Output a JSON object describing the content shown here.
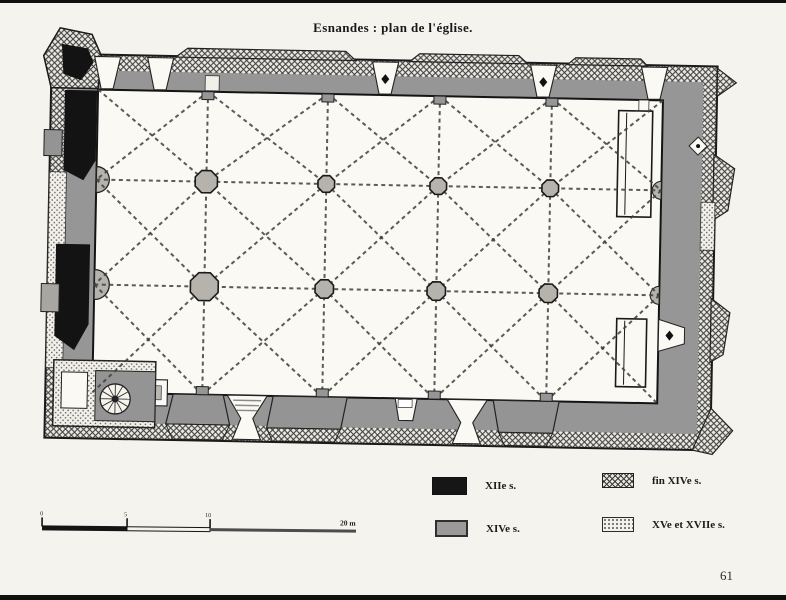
{
  "page": {
    "number": "61",
    "paper_color": "#f5f3ee"
  },
  "figure": {
    "title": "Esnandes : plan de l'église.",
    "subject": "church-floor-plan-engraving"
  },
  "legend": {
    "items": [
      {
        "id": "xii",
        "label": "XIIe s.",
        "swatch": "solid-black",
        "color": "#161616"
      },
      {
        "id": "xiv",
        "label": "XIVe s.",
        "swatch": "solid-gray",
        "color": "#9a9a9a"
      },
      {
        "id": "fin-xiv",
        "label": "fin XIVe s.",
        "swatch": "crosshatch",
        "color": "#3a3a3a"
      },
      {
        "id": "xv-xvii",
        "label": "XVe et XVIIe s.",
        "swatch": "stipple",
        "color": "#5c5c5c"
      }
    ]
  },
  "scale_bar": {
    "tick_labels": [
      "0",
      "5",
      "10"
    ],
    "end_label": "20 m"
  }
}
